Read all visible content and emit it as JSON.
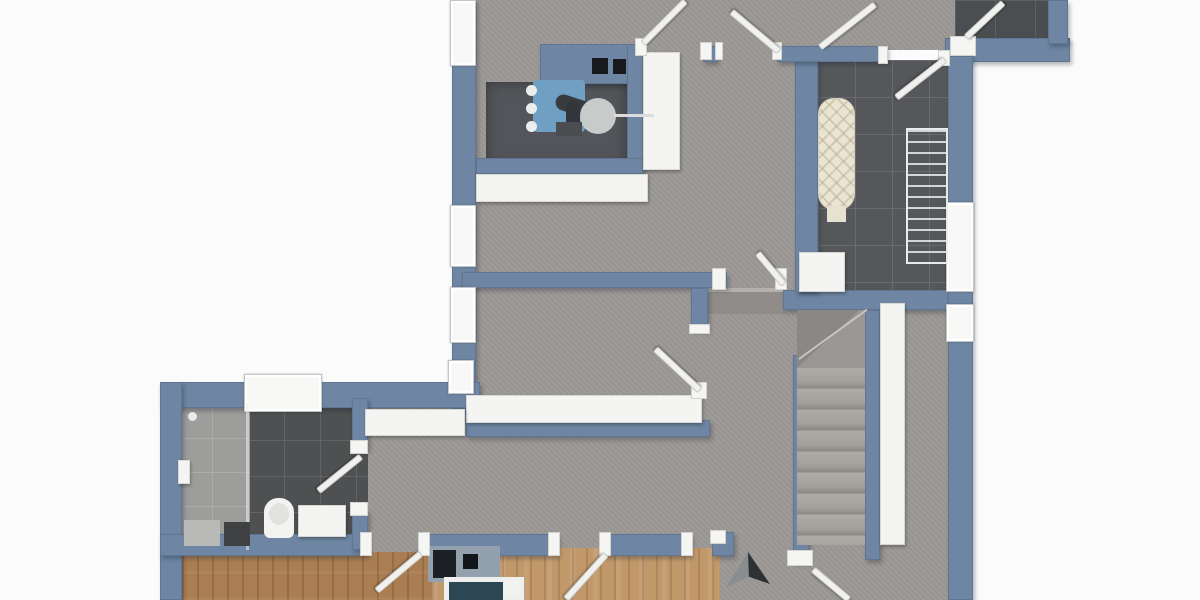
{
  "scene": {
    "description": "3D top-down architectural floor plan render, no text labels visible",
    "image_width": 1200,
    "image_height": 600,
    "background": "#fbfbfb"
  },
  "palette": {
    "wall_blue": "#6e86a3",
    "wall_edge": "#5f7692",
    "floor_gray": "#9b9895",
    "tile_dark": "#55575a",
    "tile_bathroom": "#4e5052",
    "shower_tile": "#9d9d9b",
    "wood_left_room": "#aa7e52",
    "wood_middle_room": "#c0986a",
    "white_fixture": "#f4f4f2",
    "boiler_blue": "#6fa0c4",
    "pipe_dark": "#383b3f",
    "bed_teal": "#2c4654",
    "ironing_board_cream": "#eae4d3",
    "arrow_dark": "#2e3134"
  },
  "rooms": [
    {
      "name": "upper-hallway",
      "floor": "gray-screed"
    },
    {
      "name": "technical-corner",
      "floor": "dark",
      "fixtures": [
        "boiler-unit",
        "expansion-tank",
        "wall-vents",
        "counter",
        "tall-cabinet"
      ]
    },
    {
      "name": "laundry-room",
      "floor": "dark-tile",
      "fixtures": [
        "ironing-board",
        "drying-rack",
        "washer"
      ]
    },
    {
      "name": "storage-room-top-right",
      "floor": "dark-tile",
      "fixtures": []
    },
    {
      "name": "middle-hallway",
      "floor": "gray-screed",
      "fixtures": [
        "long-sideboard",
        "radiator"
      ]
    },
    {
      "name": "bathroom",
      "floor": "dark-tile-with-shower-zone",
      "fixtures": [
        "shower",
        "toilet",
        "vanity",
        "bath-mat"
      ]
    },
    {
      "name": "staircase",
      "floor": "stone-treads",
      "straight_steps": 9,
      "winder_at_top": true
    },
    {
      "name": "bedroom-left",
      "floor": "wood"
    },
    {
      "name": "bedroom-middle",
      "floor": "wood",
      "fixtures": [
        "bed-with-teal-blanket",
        "headboard-unit",
        "dark-nightstand"
      ]
    },
    {
      "name": "south-hallway",
      "floor": "gray-screed",
      "fixtures": [
        "direction-arrow-marker"
      ]
    }
  ],
  "counts": {
    "windows_visible": 7,
    "door_leaves_visible": 11
  },
  "elements": [
    {
      "n": "floor-upper-hall",
      "k": "floor-gray",
      "x": 476,
      "y": 0,
      "w": 319,
      "h": 295
    },
    {
      "n": "floor-top-corridor",
      "k": "floor-gray",
      "x": 795,
      "y": 0,
      "w": 160,
      "h": 50
    },
    {
      "n": "floor-storage-room",
      "k": "tile-darker",
      "x": 955,
      "y": 0,
      "w": 100,
      "h": 42
    },
    {
      "n": "floor-laundry",
      "k": "tile-dark",
      "x": 818,
      "y": 60,
      "w": 130,
      "h": 232
    },
    {
      "n": "floor-middle-hall",
      "k": "floor-gray",
      "x": 476,
      "y": 286,
      "w": 332,
      "h": 270
    },
    {
      "n": "floor-hall-west",
      "k": "floor-gray",
      "x": 368,
      "y": 404,
      "w": 112,
      "h": 152
    },
    {
      "n": "floor-east-corridor",
      "k": "floor-gray",
      "x": 905,
      "y": 292,
      "w": 67,
      "h": 248
    },
    {
      "n": "floor-south-hall",
      "k": "floor-gray",
      "x": 691,
      "y": 540,
      "w": 281,
      "h": 60
    },
    {
      "n": "floor-bedroom-left",
      "k": "wood-a",
      "x": 182,
      "y": 552,
      "w": 250,
      "h": 48
    },
    {
      "n": "floor-bedroom-middle",
      "k": "wood-b",
      "x": 432,
      "y": 548,
      "w": 288,
      "h": 52
    },
    {
      "n": "floor-bathroom",
      "k": "tile-bath",
      "x": 248,
      "y": 404,
      "w": 120,
      "h": 146
    },
    {
      "n": "floor-shower",
      "k": "tile-shower",
      "x": 178,
      "y": 404,
      "w": 72,
      "h": 146
    },
    {
      "n": "floor-technical-nook",
      "k": "nook",
      "x": 486,
      "y": 82,
      "w": 141,
      "h": 84
    },
    {
      "n": "step-landing",
      "k": "flat",
      "bg": "#8f8c89",
      "x": 708,
      "y": 288,
      "w": 78,
      "h": 26
    },
    {
      "n": "step-edge-highlight",
      "k": "flat",
      "bg": "#b3b0ad",
      "x": 708,
      "y": 288,
      "w": 78,
      "h": 4
    },
    {
      "n": "wall-left-upper",
      "k": "wall",
      "x": 452,
      "y": 0,
      "w": 24,
      "h": 420
    },
    {
      "n": "wall-bathroom-top",
      "k": "wall",
      "x": 160,
      "y": 382,
      "w": 320,
      "h": 26
    },
    {
      "n": "wall-left-lower",
      "k": "wall",
      "x": 160,
      "y": 382,
      "w": 22,
      "h": 218
    },
    {
      "n": "wall-bedrooms-a",
      "k": "wall",
      "x": 160,
      "y": 534,
      "w": 208,
      "h": 22
    },
    {
      "n": "wall-bedrooms-b",
      "k": "wall",
      "x": 428,
      "y": 534,
      "w": 130,
      "h": 22
    },
    {
      "n": "wall-bedrooms-c",
      "k": "wall",
      "x": 603,
      "y": 534,
      "w": 88,
      "h": 22
    },
    {
      "n": "wall-south-pier",
      "k": "wall",
      "x": 712,
      "y": 532,
      "w": 22,
      "h": 24
    },
    {
      "n": "wall-bath-right-a",
      "k": "wall",
      "x": 352,
      "y": 398,
      "w": 16,
      "h": 52
    },
    {
      "n": "wall-bath-right-b",
      "k": "wall",
      "x": 352,
      "y": 510,
      "w": 16,
      "h": 40
    },
    {
      "n": "wall-middle",
      "k": "wall",
      "x": 462,
      "y": 272,
      "w": 265,
      "h": 16
    },
    {
      "n": "wall-stub",
      "k": "wall",
      "x": 691,
      "y": 288,
      "w": 17,
      "h": 42
    },
    {
      "n": "wall-sideboard-back",
      "k": "wall",
      "x": 466,
      "y": 420,
      "w": 244,
      "h": 17
    },
    {
      "n": "wall-stair-top",
      "k": "wall",
      "x": 783,
      "y": 290,
      "w": 167,
      "h": 20
    },
    {
      "n": "wall-stair-left",
      "k": "wall",
      "x": 793,
      "y": 355,
      "w": 16,
      "h": 207
    },
    {
      "n": "wall-stair-right",
      "k": "wall",
      "x": 865,
      "y": 310,
      "w": 15,
      "h": 250
    },
    {
      "n": "wall-laundry-left",
      "k": "wall",
      "x": 795,
      "y": 52,
      "w": 23,
      "h": 240
    },
    {
      "n": "wall-technical-top",
      "k": "wall",
      "x": 540,
      "y": 44,
      "w": 103,
      "h": 40
    },
    {
      "n": "wall-top-middle",
      "k": "wall",
      "x": 777,
      "y": 46,
      "w": 110,
      "h": 16
    },
    {
      "n": "wall-top-pier",
      "k": "wall",
      "x": 703,
      "y": 46,
      "w": 14,
      "h": 16
    },
    {
      "n": "wall-storage-bottom",
      "k": "wall",
      "x": 945,
      "y": 38,
      "w": 125,
      "h": 24
    },
    {
      "n": "wall-storage-right",
      "k": "wall",
      "x": 1048,
      "y": 0,
      "w": 20,
      "h": 44
    },
    {
      "n": "wall-right-outer",
      "k": "wall",
      "x": 948,
      "y": 56,
      "w": 25,
      "h": 544
    },
    {
      "n": "wall-technical-right",
      "k": "wall",
      "x": 627,
      "y": 44,
      "w": 16,
      "h": 124
    },
    {
      "n": "wall-under-nook",
      "k": "wall",
      "x": 476,
      "y": 158,
      "w": 167,
      "h": 16
    },
    {
      "n": "window-left-1",
      "k": "window",
      "x": 450,
      "y": 0,
      "w": 26,
      "h": 66
    },
    {
      "n": "window-left-2",
      "k": "window",
      "x": 450,
      "y": 205,
      "w": 26,
      "h": 62
    },
    {
      "n": "window-left-3",
      "k": "window",
      "x": 450,
      "y": 287,
      "w": 26,
      "h": 56
    },
    {
      "n": "window-left-4",
      "k": "window",
      "x": 448,
      "y": 360,
      "w": 26,
      "h": 34
    },
    {
      "n": "window-bathroom",
      "k": "window",
      "x": 244,
      "y": 374,
      "w": 78,
      "h": 38
    },
    {
      "n": "window-right-1",
      "k": "window",
      "x": 946,
      "y": 202,
      "w": 28,
      "h": 90
    },
    {
      "n": "window-right-2",
      "k": "window",
      "x": 946,
      "y": 304,
      "w": 28,
      "h": 38
    },
    {
      "n": "stairs-winder-base",
      "k": "flat",
      "bg": "#9a9794",
      "x": 797,
      "y": 310,
      "w": 68,
      "h": 58
    },
    {
      "n": "stairs-winder-shadow",
      "k": "flat",
      "bg": "#8a8784",
      "clip": "polygon(0 0, 92% 0, 0 100%)",
      "x": 797,
      "y": 310,
      "w": 68,
      "h": 58
    },
    {
      "n": "stairs-winder-edge",
      "k": "flat",
      "bg": "#c9c6c2",
      "x": 799,
      "y": 358,
      "w": 84,
      "h": 2,
      "rot": -36
    },
    {
      "n": "stairs-treads",
      "k": "treads",
      "x": 797,
      "y": 368,
      "w": 68,
      "h": 177
    },
    {
      "n": "stairs-side-partition",
      "k": "furn",
      "x": 880,
      "y": 303,
      "w": 25,
      "h": 242
    },
    {
      "n": "counter-upper",
      "k": "furn",
      "x": 476,
      "y": 174,
      "w": 172,
      "h": 28
    },
    {
      "n": "cabinet-tall",
      "k": "furn",
      "x": 643,
      "y": 52,
      "w": 37,
      "h": 118
    },
    {
      "n": "sideboard-long",
      "k": "furn",
      "x": 466,
      "y": 395,
      "w": 236,
      "h": 28
    },
    {
      "n": "radiator-hall",
      "k": "furn",
      "x": 365,
      "y": 409,
      "w": 100,
      "h": 27
    },
    {
      "n": "washer-laundry",
      "k": "furn",
      "x": 799,
      "y": 252,
      "w": 46,
      "h": 40
    },
    {
      "n": "boiler-body",
      "k": "flat",
      "bg": "#6fa0c4",
      "br": "4px",
      "x": 533,
      "y": 80,
      "w": 52,
      "h": 52
    },
    {
      "n": "boiler-knob-1",
      "k": "flat",
      "bg": "#eceeee",
      "br": "50%",
      "x": 526,
      "y": 85,
      "w": 11,
      "h": 11
    },
    {
      "n": "boiler-knob-2",
      "k": "flat",
      "bg": "#eceeee",
      "br": "50%",
      "x": 526,
      "y": 103,
      "w": 11,
      "h": 11
    },
    {
      "n": "boiler-knob-3",
      "k": "flat",
      "bg": "#eceeee",
      "br": "50%",
      "x": 526,
      "y": 121,
      "w": 11,
      "h": 11
    },
    {
      "n": "boiler-pipe-curve",
      "k": "flat",
      "bg": "#383b3f",
      "br": "10px",
      "x": 556,
      "y": 92,
      "w": 52,
      "h": 16,
      "rot": 18
    },
    {
      "n": "boiler-pipe-down",
      "k": "flat",
      "bg": "#33363a",
      "br": "8px",
      "x": 566,
      "y": 100,
      "w": 14,
      "h": 34
    },
    {
      "n": "boiler-expansion-tank",
      "k": "flat",
      "bg": "#c9cbca",
      "br": "50%",
      "x": 580,
      "y": 98,
      "w": 36,
      "h": 36
    },
    {
      "n": "boiler-pipe-thin",
      "k": "flat",
      "bg": "#dadbda",
      "x": 614,
      "y": 114,
      "w": 40,
      "h": 3
    },
    {
      "n": "boiler-base-dark",
      "k": "flat",
      "bg": "#4a4d50",
      "x": 556,
      "y": 122,
      "w": 26,
      "h": 14
    },
    {
      "n": "wall-vent-1",
      "k": "flat",
      "bg": "#17191c",
      "x": 592,
      "y": 58,
      "w": 16,
      "h": 16
    },
    {
      "n": "wall-vent-2",
      "k": "flat",
      "bg": "#17191c",
      "x": 613,
      "y": 59,
      "w": 13,
      "h": 15
    },
    {
      "n": "ironing-board",
      "k": "iron",
      "br": "16px",
      "x": 818,
      "y": 98,
      "w": 37,
      "h": 112
    },
    {
      "n": "ironing-board-tail",
      "k": "flat",
      "bg": "#e7e1d0",
      "x": 827,
      "y": 206,
      "w": 19,
      "h": 16
    },
    {
      "n": "drying-rack",
      "k": "rack",
      "x": 906,
      "y": 128,
      "w": 42,
      "h": 136
    },
    {
      "n": "shower-glass-divider",
      "k": "flat",
      "bg": "rgba(235,238,240,0.55)",
      "x": 246,
      "y": 404,
      "w": 3,
      "h": 146
    },
    {
      "n": "shower-head",
      "k": "furn",
      "x": 178,
      "y": 460,
      "w": 12,
      "h": 24
    },
    {
      "n": "shower-valve",
      "k": "flat",
      "bg": "#e8e9e9",
      "br": "50%",
      "x": 188,
      "y": 412,
      "w": 9,
      "h": 9
    },
    {
      "n": "shower-seat",
      "k": "flat",
      "bg": "#b9b9b7",
      "x": 184,
      "y": 520,
      "w": 36,
      "h": 26
    },
    {
      "n": "bath-mat",
      "k": "flat",
      "bg": "#3f4143",
      "x": 224,
      "y": 522,
      "w": 26,
      "h": 24
    },
    {
      "n": "toilet",
      "k": "flat",
      "bg": "#f3f4f2",
      "br": "14px 14px 6px 6px",
      "x": 264,
      "y": 498,
      "w": 30,
      "h": 40
    },
    {
      "n": "toilet-bowl",
      "k": "flat",
      "bg": "#e2e3e1",
      "br": "50%",
      "x": 269,
      "y": 503,
      "w": 20,
      "h": 22
    },
    {
      "n": "vanity",
      "k": "furn",
      "x": 298,
      "y": 505,
      "w": 48,
      "h": 32
    },
    {
      "n": "headboard-unit",
      "k": "flat",
      "bg": "#93a0ae",
      "x": 428,
      "y": 546,
      "w": 72,
      "h": 36
    },
    {
      "n": "nightstand-dark",
      "k": "flat",
      "bg": "#1c2024",
      "x": 433,
      "y": 550,
      "w": 23,
      "h": 28
    },
    {
      "n": "dark-box-small",
      "k": "flat",
      "bg": "#121518",
      "x": 463,
      "y": 554,
      "w": 15,
      "h": 15
    },
    {
      "n": "bed-frame",
      "k": "flat",
      "bg": "#eff0ee",
      "x": 444,
      "y": 577,
      "w": 80,
      "h": 23
    },
    {
      "n": "bed-blanket",
      "k": "flat",
      "bg": "#2c4654",
      "x": 449,
      "y": 582,
      "w": 54,
      "h": 18
    },
    {
      "n": "bed-pillow",
      "k": "flat",
      "bg": "#f2f3f1",
      "br": "3px",
      "x": 504,
      "y": 580,
      "w": 17,
      "h": 17
    },
    {
      "n": "jamb-tech-door-left",
      "k": "jamb",
      "x": 635,
      "y": 38,
      "w": 12,
      "h": 18
    },
    {
      "n": "jamb-tech-door-right",
      "k": "jamb",
      "x": 700,
      "y": 42,
      "w": 12,
      "h": 18
    },
    {
      "n": "jamb-north-door-left",
      "k": "jamb",
      "x": 715,
      "y": 42,
      "w": 8,
      "h": 18
    },
    {
      "n": "jamb-north-door-right",
      "k": "jamb",
      "x": 772,
      "y": 42,
      "w": 10,
      "h": 18
    },
    {
      "n": "jamb-laundry-left",
      "k": "jamb",
      "x": 878,
      "y": 46,
      "w": 10,
      "h": 18
    },
    {
      "n": "jamb-laundry-right",
      "k": "jamb",
      "x": 938,
      "y": 50,
      "w": 12,
      "h": 16
    },
    {
      "n": "jamb-storage-door",
      "k": "jamb",
      "x": 950,
      "y": 36,
      "w": 26,
      "h": 20
    },
    {
      "n": "jamb-mid-door-left",
      "k": "jamb",
      "x": 712,
      "y": 268,
      "w": 14,
      "h": 22
    },
    {
      "n": "jamb-mid-door-right",
      "k": "jamb",
      "x": 775,
      "y": 268,
      "w": 12,
      "h": 22
    },
    {
      "n": "jamb-stub-cap",
      "k": "jamb",
      "x": 689,
      "y": 324,
      "w": 21,
      "h": 10
    },
    {
      "n": "jamb-sideboard-end",
      "k": "jamb",
      "x": 691,
      "y": 382,
      "w": 16,
      "h": 17
    },
    {
      "n": "jamb-bath-door-top",
      "k": "jamb",
      "x": 350,
      "y": 440,
      "w": 18,
      "h": 14
    },
    {
      "n": "jamb-bath-door-bottom",
      "k": "jamb",
      "x": 350,
      "y": 502,
      "w": 18,
      "h": 14
    },
    {
      "n": "jamb-bed1-left",
      "k": "jamb",
      "x": 360,
      "y": 532,
      "w": 12,
      "h": 24
    },
    {
      "n": "jamb-bed1-right",
      "k": "jamb",
      "x": 418,
      "y": 532,
      "w": 12,
      "h": 24
    },
    {
      "n": "jamb-bed2-left",
      "k": "jamb",
      "x": 548,
      "y": 532,
      "w": 12,
      "h": 24
    },
    {
      "n": "jamb-bed2-right",
      "k": "jamb",
      "x": 599,
      "y": 532,
      "w": 12,
      "h": 24
    },
    {
      "n": "jamb-south-opening",
      "k": "jamb",
      "x": 681,
      "y": 532,
      "w": 12,
      "h": 24
    },
    {
      "n": "jamb-south-pier",
      "k": "jamb",
      "x": 710,
      "y": 530,
      "w": 16,
      "h": 14
    },
    {
      "n": "jamb-understair",
      "k": "jamb",
      "x": 787,
      "y": 550,
      "w": 26,
      "h": 16
    },
    {
      "n": "door-leaf-technical",
      "k": "door",
      "x": 643,
      "y": 40,
      "w": 60,
      "h": 7,
      "rot": -45
    },
    {
      "n": "door-leaf-north-hall",
      "k": "door",
      "x": 779,
      "y": 48,
      "w": 62,
      "h": 7,
      "rot": -140
    },
    {
      "n": "door-leaf-north-east",
      "k": "door",
      "x": 820,
      "y": 44,
      "w": 70,
      "h": 7,
      "rot": -38
    },
    {
      "n": "door-leaf-laundry",
      "k": "door",
      "x": 945,
      "y": 56,
      "w": 62,
      "h": 7,
      "rot": 142
    },
    {
      "n": "door-leaf-storage",
      "k": "door",
      "x": 966,
      "y": 34,
      "w": 51,
      "h": 7,
      "rot": -43
    },
    {
      "n": "door-leaf-middle-hall",
      "k": "door",
      "x": 784,
      "y": 281,
      "w": 41,
      "h": 7,
      "rot": -130
    },
    {
      "n": "door-leaf-sideboard-wall",
      "k": "door",
      "x": 700,
      "y": 387,
      "w": 61,
      "h": 7,
      "rot": -137
    },
    {
      "n": "door-leaf-bathroom",
      "k": "door",
      "x": 361,
      "y": 453,
      "w": 55,
      "h": 7,
      "rot": 141
    },
    {
      "n": "door-leaf-bedroom-left",
      "k": "door",
      "x": 421,
      "y": 550,
      "w": 58,
      "h": 7,
      "rot": 140
    },
    {
      "n": "door-leaf-bedroom-middle",
      "k": "door",
      "x": 606,
      "y": 551,
      "w": 60,
      "h": 7,
      "rot": 132
    },
    {
      "n": "door-leaf-understair",
      "k": "door",
      "x": 813,
      "y": 566,
      "w": 47,
      "h": 7,
      "rot": 40
    },
    {
      "n": "direction-arrow-left-face",
      "k": "flat",
      "bg": "#8a8d8f",
      "clip": "polygon(50% 0, 0 88%, 52% 62%)",
      "x": 726,
      "y": 552,
      "w": 44,
      "h": 40
    },
    {
      "n": "direction-arrow-right-face",
      "k": "flat",
      "bg": "#2e3134",
      "clip": "polygon(50% 0, 52% 62%, 100% 80%)",
      "x": 726,
      "y": 552,
      "w": 44,
      "h": 40
    }
  ]
}
